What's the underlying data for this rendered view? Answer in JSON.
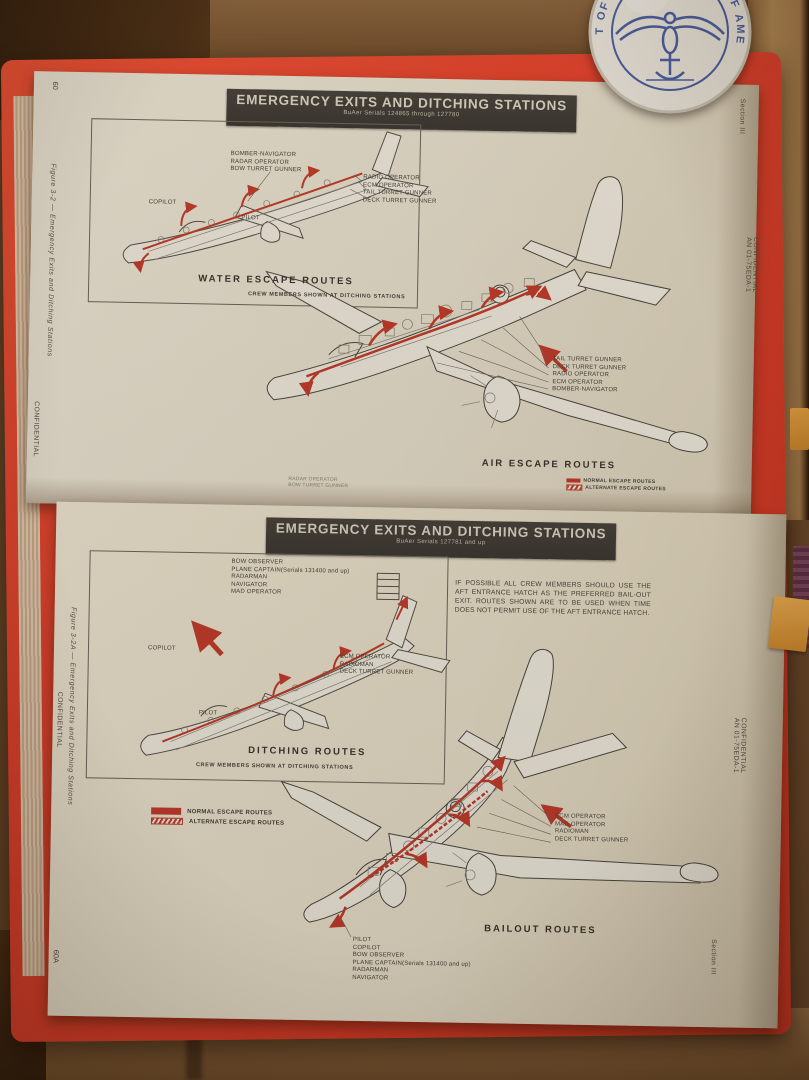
{
  "seal": {
    "rim_left": "T OF THE NAVY",
    "rim_right": "STATES OF AMERICA"
  },
  "top_page": {
    "page_number": "60",
    "figure_caption": "Figure 3-2 — Emergency Exits and Ditching Stations",
    "confidential_left": "CONFIDENTIAL",
    "section_label": "Section III",
    "confidential_right": "CONFIDENTIAL",
    "doc_number": "AN 01-75EDA-1",
    "banner_title": "EMERGENCY EXITS AND DITCHING STATIONS",
    "banner_subtitle": "BuAer Serials 124865 through 127780",
    "inset": {
      "labels_upper_left": [
        "BOMBER-NAVIGATOR",
        "RADAR OPERATOR",
        "BOW TURRET GUNNER"
      ],
      "label_copilot": "COPILOT",
      "label_pilot": "PILOT",
      "labels_right": [
        "RADIO OPERATOR",
        "ECM OPERATOR",
        "TAIL TURRET GUNNER",
        "DECK TURRET GUNNER"
      ],
      "caption": "WATER ESCAPE ROUTES",
      "subcaption": "CREW MEMBERS SHOWN AT DITCHING STATIONS"
    },
    "main": {
      "labels_right": [
        "TAIL TURRET GUNNER",
        "DECK TURRET GUNNER",
        "RADIO OPERATOR",
        "ECM OPERATOR",
        "BOMBER-NAVIGATOR"
      ],
      "caption": "AIR ESCAPE ROUTES",
      "labels_lower_left": [
        "RADAR OPERATOR",
        "BOW TURRET GUNNER"
      ],
      "legend": [
        "NORMAL ESCAPE ROUTES",
        "ALTERNATE ESCAPE ROUTES"
      ]
    }
  },
  "bottom_page": {
    "page_number": "60A",
    "figure_caption": "Figure 3-2A — Emergency Exits and Ditching Stations",
    "confidential_left": "CONFIDENTIAL",
    "section_label": "Section III",
    "confidential_right": "CONFIDENTIAL",
    "doc_number": "AN 01-75EDA-1",
    "banner_title": "EMERGENCY EXITS AND DITCHING STATIONS",
    "banner_subtitle": "BuAer Serials 127781 and up",
    "inset": {
      "labels_top": [
        "BOW OBSERVER",
        "PLANE CAPTAIN(Serials 131400 and up)",
        "RADARMAN",
        "NAVIGATOR",
        "MAD OPERATOR"
      ],
      "label_copilot": "COPILOT",
      "label_pilot": "PILOT",
      "labels_mid": [
        "ECM OPERATOR",
        "RADIOMAN",
        "DECK TURRET GUNNER"
      ],
      "caption": "DITCHING ROUTES",
      "subcaption": "CREW MEMBERS SHOWN AT DITCHING STATIONS"
    },
    "note": "IF POSSIBLE ALL CREW MEMBERS SHOULD USE THE AFT ENTRANCE HATCH AS THE PREFERRED BAIL-OUT EXIT. ROUTES SHOWN ARE TO BE USED WHEN TIME DOES NOT PERMIT USE OF THE AFT ENTRANCE HATCH.",
    "legend": [
      {
        "label": "NORMAL ESCAPE ROUTES"
      },
      {
        "label": "ALTERNATE ESCAPE ROUTES"
      }
    ],
    "main": {
      "labels_right": [
        "ECM OPERATOR",
        "MAD OPERATOR",
        "RADIOMAN",
        "DECK TURRET GUNNER"
      ],
      "caption": "BAILOUT ROUTES",
      "labels_bottom": [
        "PILOT",
        "COPILOT",
        "BOW OBSERVER",
        "PLANE CAPTAIN(Serials 131400 and up)",
        "RADARMAN",
        "NAVIGATOR"
      ]
    }
  }
}
